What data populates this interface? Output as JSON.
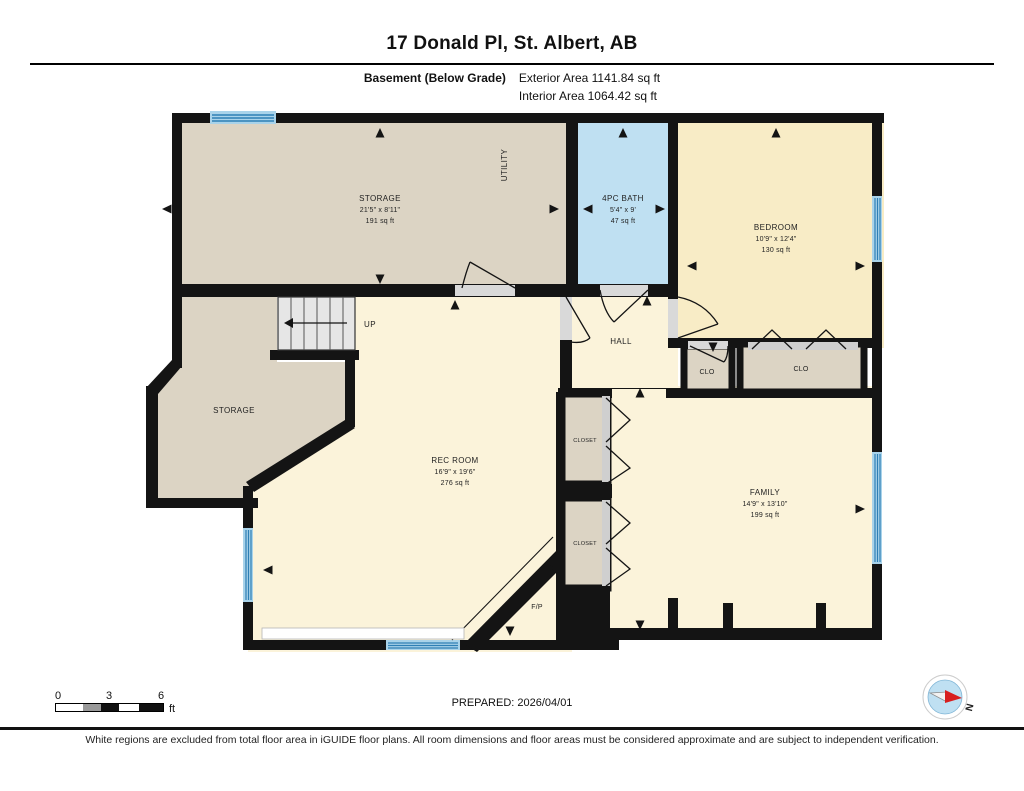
{
  "header": {
    "title": "17 Donald Pl, St. Albert, AB",
    "floor_label": "Basement (Below Grade)",
    "exterior_area": "Exterior Area 1141.84 sq ft",
    "interior_area": "Interior Area 1064.42 sq ft"
  },
  "rooms": {
    "storage_top": {
      "name": "STORAGE",
      "dims": "21'5\" x 8'11\"",
      "area": "191 sq ft"
    },
    "utility": {
      "name": "UTILITY"
    },
    "bath": {
      "name": "4PC BATH",
      "dims": "5'4\" x 9'",
      "area": "47 sq ft"
    },
    "bedroom": {
      "name": "BEDROOM",
      "dims": "10'9\" x 12'4\"",
      "area": "130 sq ft"
    },
    "hall": {
      "name": "HALL"
    },
    "clo_small": {
      "name": "CLO"
    },
    "clo_large": {
      "name": "CLO"
    },
    "storage_lower": {
      "name": "STORAGE"
    },
    "rec_room": {
      "name": "REC ROOM",
      "dims": "16'9\" x 19'6\"",
      "area": "276 sq ft"
    },
    "closet_upper": {
      "name": "CLOSET"
    },
    "closet_lower": {
      "name": "CLOSET"
    },
    "family": {
      "name": "FAMILY",
      "dims": "14'9\" x 13'10\"",
      "area": "199 sq ft"
    },
    "fireplace": {
      "name": "F/P"
    },
    "stairs": {
      "label": "UP"
    }
  },
  "scale_bar": {
    "tick0": "0",
    "tick3": "3",
    "tick6": "6",
    "unit": "ft"
  },
  "footer": {
    "prepared": "PREPARED: 2026/04/01",
    "compass_label": "N",
    "disclaimer": "White regions are excluded from total floor area in iGUIDE floor plans. All room dimensions and floor areas must be considered approximate and are subject to independent verification."
  },
  "colors": {
    "wall": "#141414",
    "beige_room": "#dcd4c4",
    "cream_room": "#fbf3da",
    "yellow_room": "#f8ecc6",
    "bath_blue": "#bfe0f2",
    "window_blue": "#a9d3ea",
    "window_stripe": "#2e7fb5",
    "compass_red": "#d81e1e"
  }
}
